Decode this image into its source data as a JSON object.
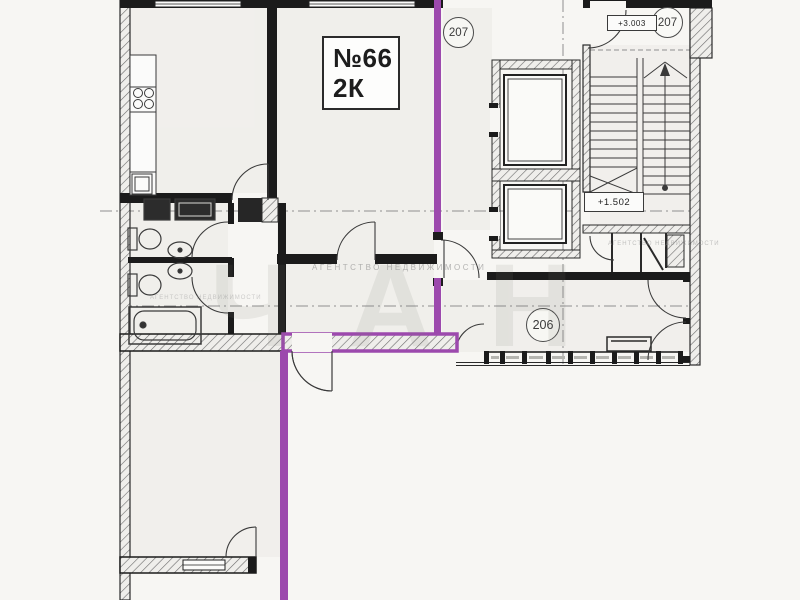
{
  "plan": {
    "apartment_box": {
      "number": "№66",
      "type": "2К"
    },
    "circles": {
      "lift_hall": "207",
      "stairwell": "207",
      "corridor": "206"
    },
    "elevations": {
      "upper": "+3.003",
      "mid_landing": "+1.502"
    },
    "watermark": {
      "big": "ЧАН",
      "small": "АГЕНТСТВО НЕДВИЖИМОСТИ"
    },
    "colors": {
      "boundary_highlight": "#9c49ad",
      "walls": "#1b1b1b",
      "paper": "#f7f6f3",
      "axis": "#8f8f8f"
    }
  }
}
